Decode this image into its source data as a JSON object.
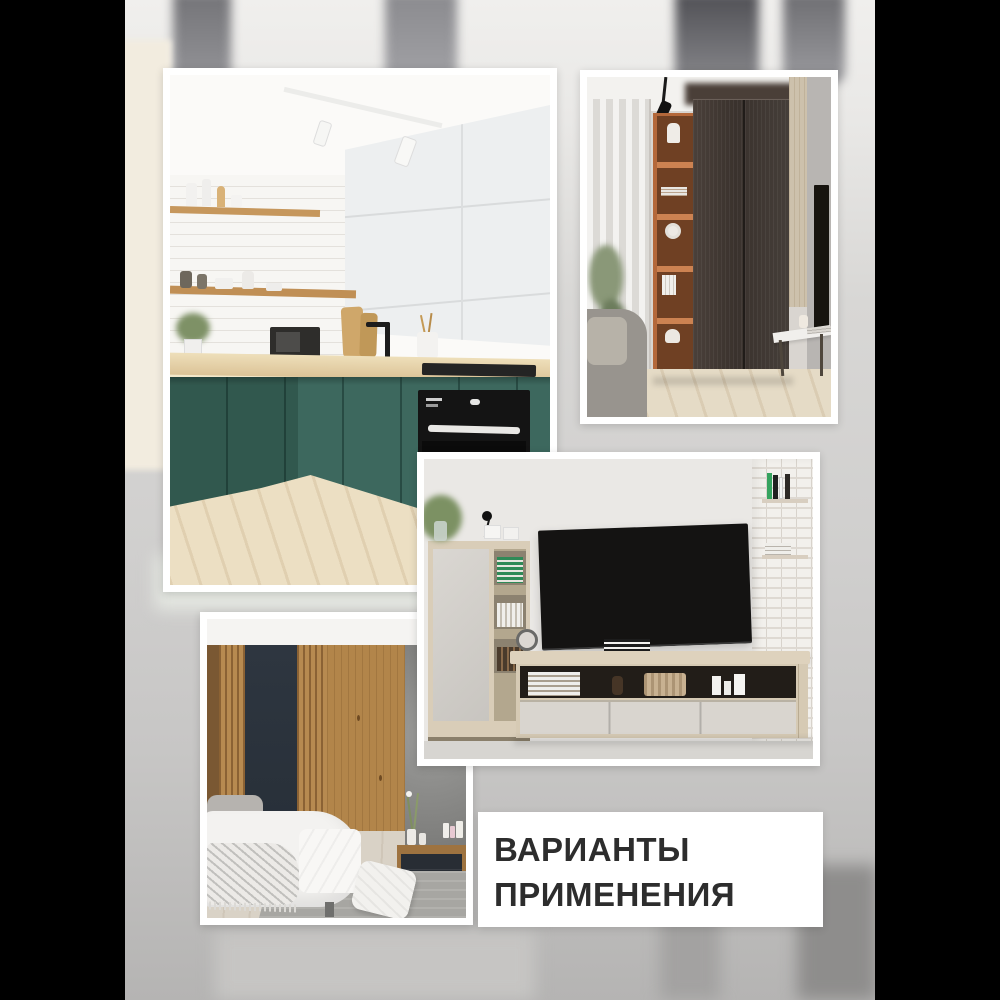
{
  "caption": {
    "line1": "ВАРИАНТЫ",
    "line2": "ПРИМЕНЕНИЯ",
    "text_color": "#2d2d2d",
    "box_color": "#ffffff"
  },
  "photos": [
    {
      "name": "kitchen",
      "description": "Corner kitchen: white upper cabinets, open wood shelves with dishes, white subway-tile wall, wooden worktop, teal-green lower cabinets, built-in black oven, black tap, light plank floor, white track lights"
    },
    {
      "name": "wardrobe-room",
      "description": "Room corner: sheer white curtains at window, tall orange open shelving with vases and books, dark brown two-door wardrobe to ceiling, black track spotlight, gray sofa, white console, light wood floor"
    },
    {
      "name": "tv-living-room",
      "description": "Living room: black TV on light gray wall, light oak media bench with open shelf of books, basket and candles, oak cabinet with plant and black lamp on top, white brick wall with book shelves"
    },
    {
      "name": "bedroom",
      "description": "Bedroom: vertical wood slat wall panels with charcoal panel, gray concrete niche with white ball pendant light, cosmetics on dark dresser, white bed with throw, gray rug"
    }
  ],
  "background": {
    "letterbox_color": "#000000",
    "backdrop_top": "#f0efed",
    "backdrop_bottom": "#b5b4b3",
    "blurred_elements": "ceiling track spotlights, cream wall strip, furniture shadows"
  },
  "palette": {
    "kitchen_teal": "#3d685e",
    "worktop_wood": "#e3cfa4",
    "shelf_orange": "#b4683a",
    "wardrobe_brown": "#3f3631",
    "slat_wood": "#b2854a",
    "panel_charcoal": "#2b323b",
    "oak_light": "#d9cdb8",
    "frame_white": "#ffffff"
  }
}
